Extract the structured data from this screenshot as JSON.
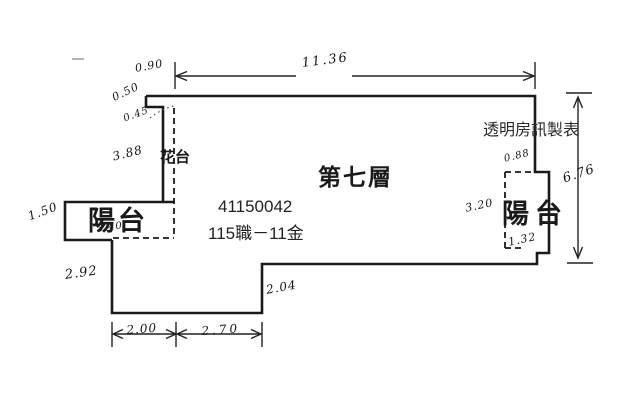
{
  "colors": {
    "background": "#ffffff",
    "wall_line": "#1a1a1a",
    "dimension_line": "#222222",
    "handwriting": "#151515",
    "typed_text": "#2a2a2a"
  },
  "plan": {
    "floor_label": "第七層",
    "planter_label": "花台",
    "balcony_left_label": "陽台",
    "balcony_right_label": "陽台",
    "maker_label": "透明房訊製表",
    "serial_number": "41150042",
    "parcel_code": "115職－11金",
    "dimensions": {
      "top_offset": "0.90",
      "top_width": "11.36",
      "right_height": "6.76",
      "left_step": "0.50",
      "left_diagonal": "0.45",
      "planter_height": "3.88",
      "balcony_left_depth": "1.50",
      "balcony_left_width": "3.40",
      "lower_left_height": "2.92",
      "bottom_segment_1": "2.00",
      "bottom_segment_2": "2.70",
      "bottom_step_height": "2.04",
      "balcony_right_top": "0.88",
      "balcony_right_height": "3.20",
      "balcony_right_bottom": "1.32"
    }
  }
}
